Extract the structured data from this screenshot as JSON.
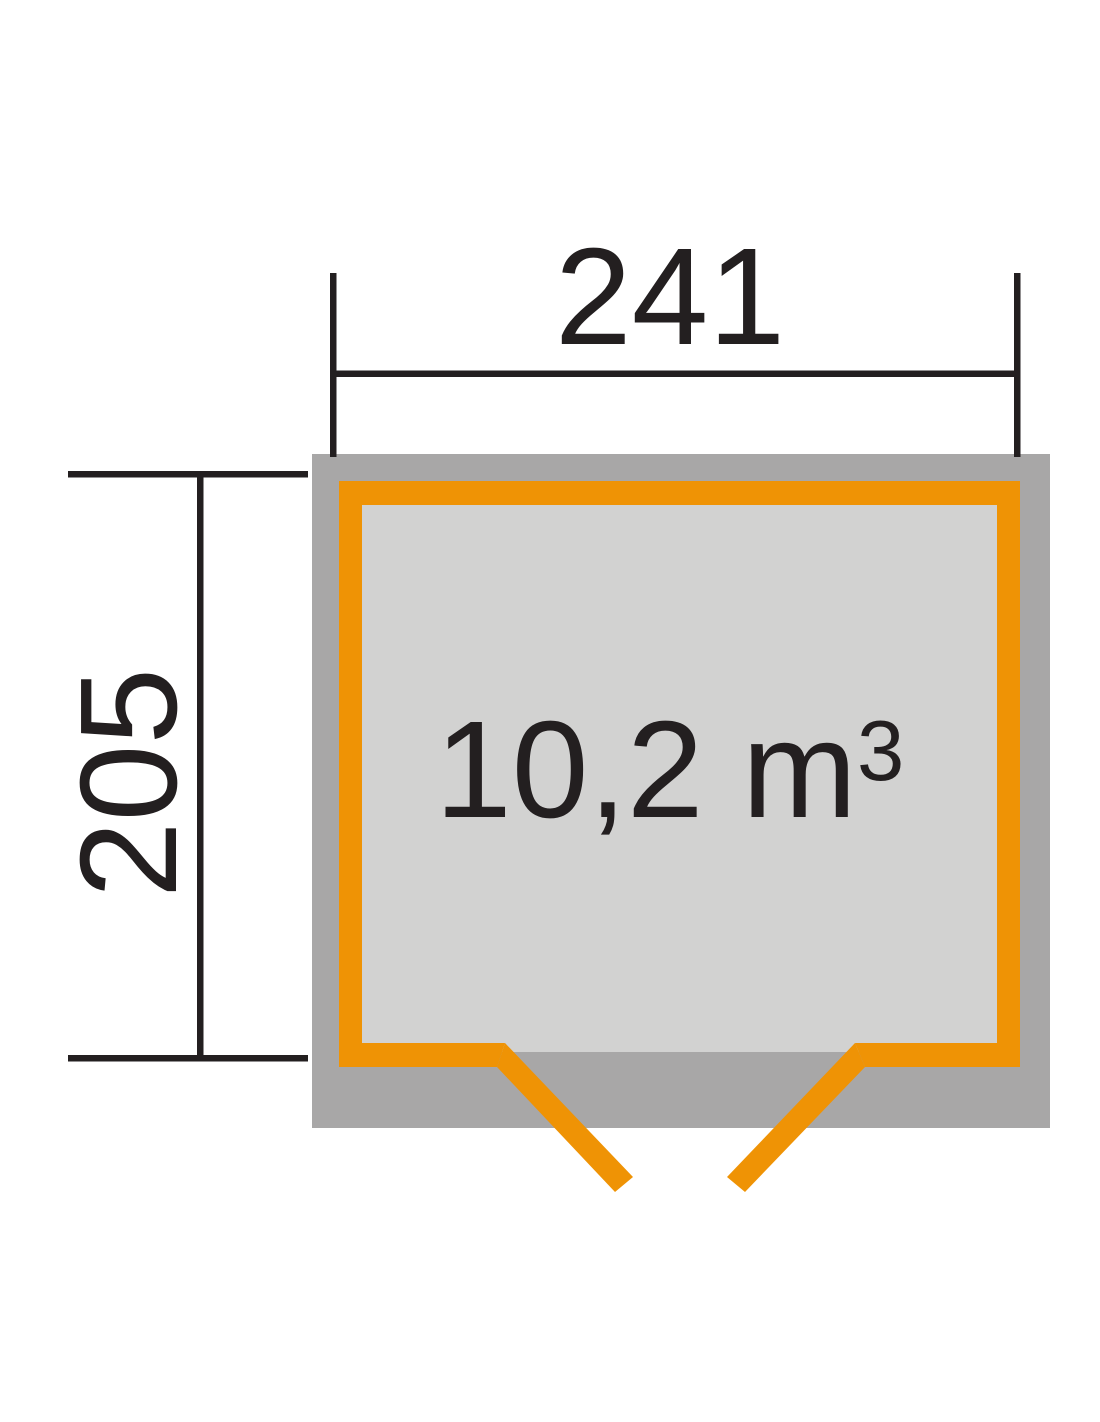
{
  "floorplan": {
    "type": "garden-shed top view",
    "width_label": "241",
    "depth_label": "205",
    "volume": {
      "full": "10,2 m³",
      "base": "10,2 m",
      "exponent": "3"
    }
  },
  "colors": {
    "wall_accent_orange": "#EF9305",
    "structure_gray": "#A8A7A7",
    "floor_light_gray": "#D2D2D1",
    "dimension_black": "#231F20",
    "background": "#FFFFFF"
  }
}
